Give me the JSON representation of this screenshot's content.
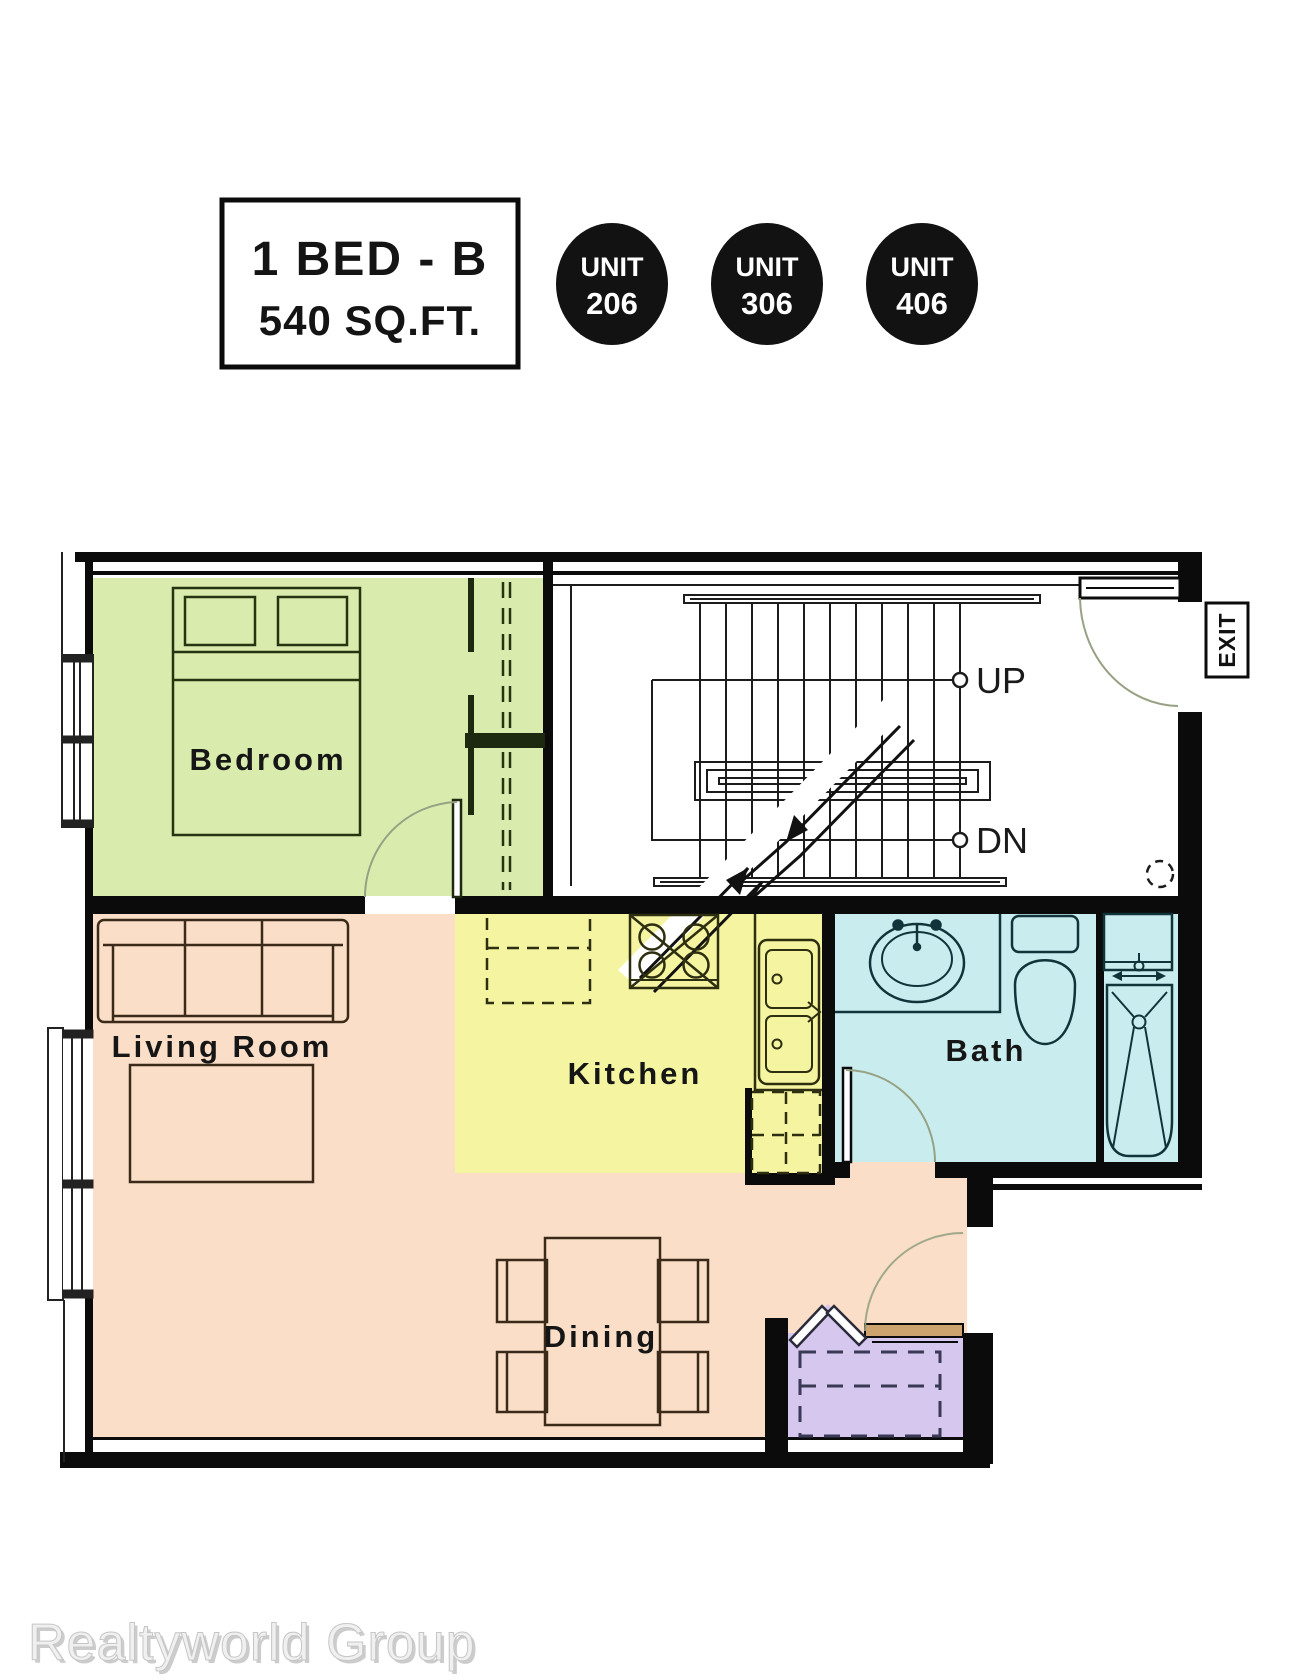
{
  "header": {
    "plan_box": {
      "line1": "1 BED - B",
      "line2": "540 SQ.FT."
    },
    "units": [
      {
        "label": "UNIT",
        "number": "206"
      },
      {
        "label": "UNIT",
        "number": "306"
      },
      {
        "label": "UNIT",
        "number": "406"
      }
    ]
  },
  "rooms": {
    "bedroom": "Bedroom",
    "living_room": "Living Room",
    "kitchen": "Kitchen",
    "bath": "Bath",
    "dining": "Dining"
  },
  "stairwell": {
    "up": "UP",
    "down": "DN",
    "exit": "EXIT"
  },
  "watermark": "Realtyworld Group",
  "colors": {
    "bedroom_fill": "#d9ecae",
    "living_fill": "#fadec7",
    "kitchen_fill": "#f5f5a1",
    "bath_fill": "#c9edee",
    "closet_fill": "#d5c7ee",
    "door_leaf": "#cda46e",
    "unit_badge": "#121212",
    "wall": "#0b0b0b",
    "swing_arc": "#97a184",
    "watermark_fill": "#f0f0f0",
    "watermark_shadow": "#cccccc"
  }
}
